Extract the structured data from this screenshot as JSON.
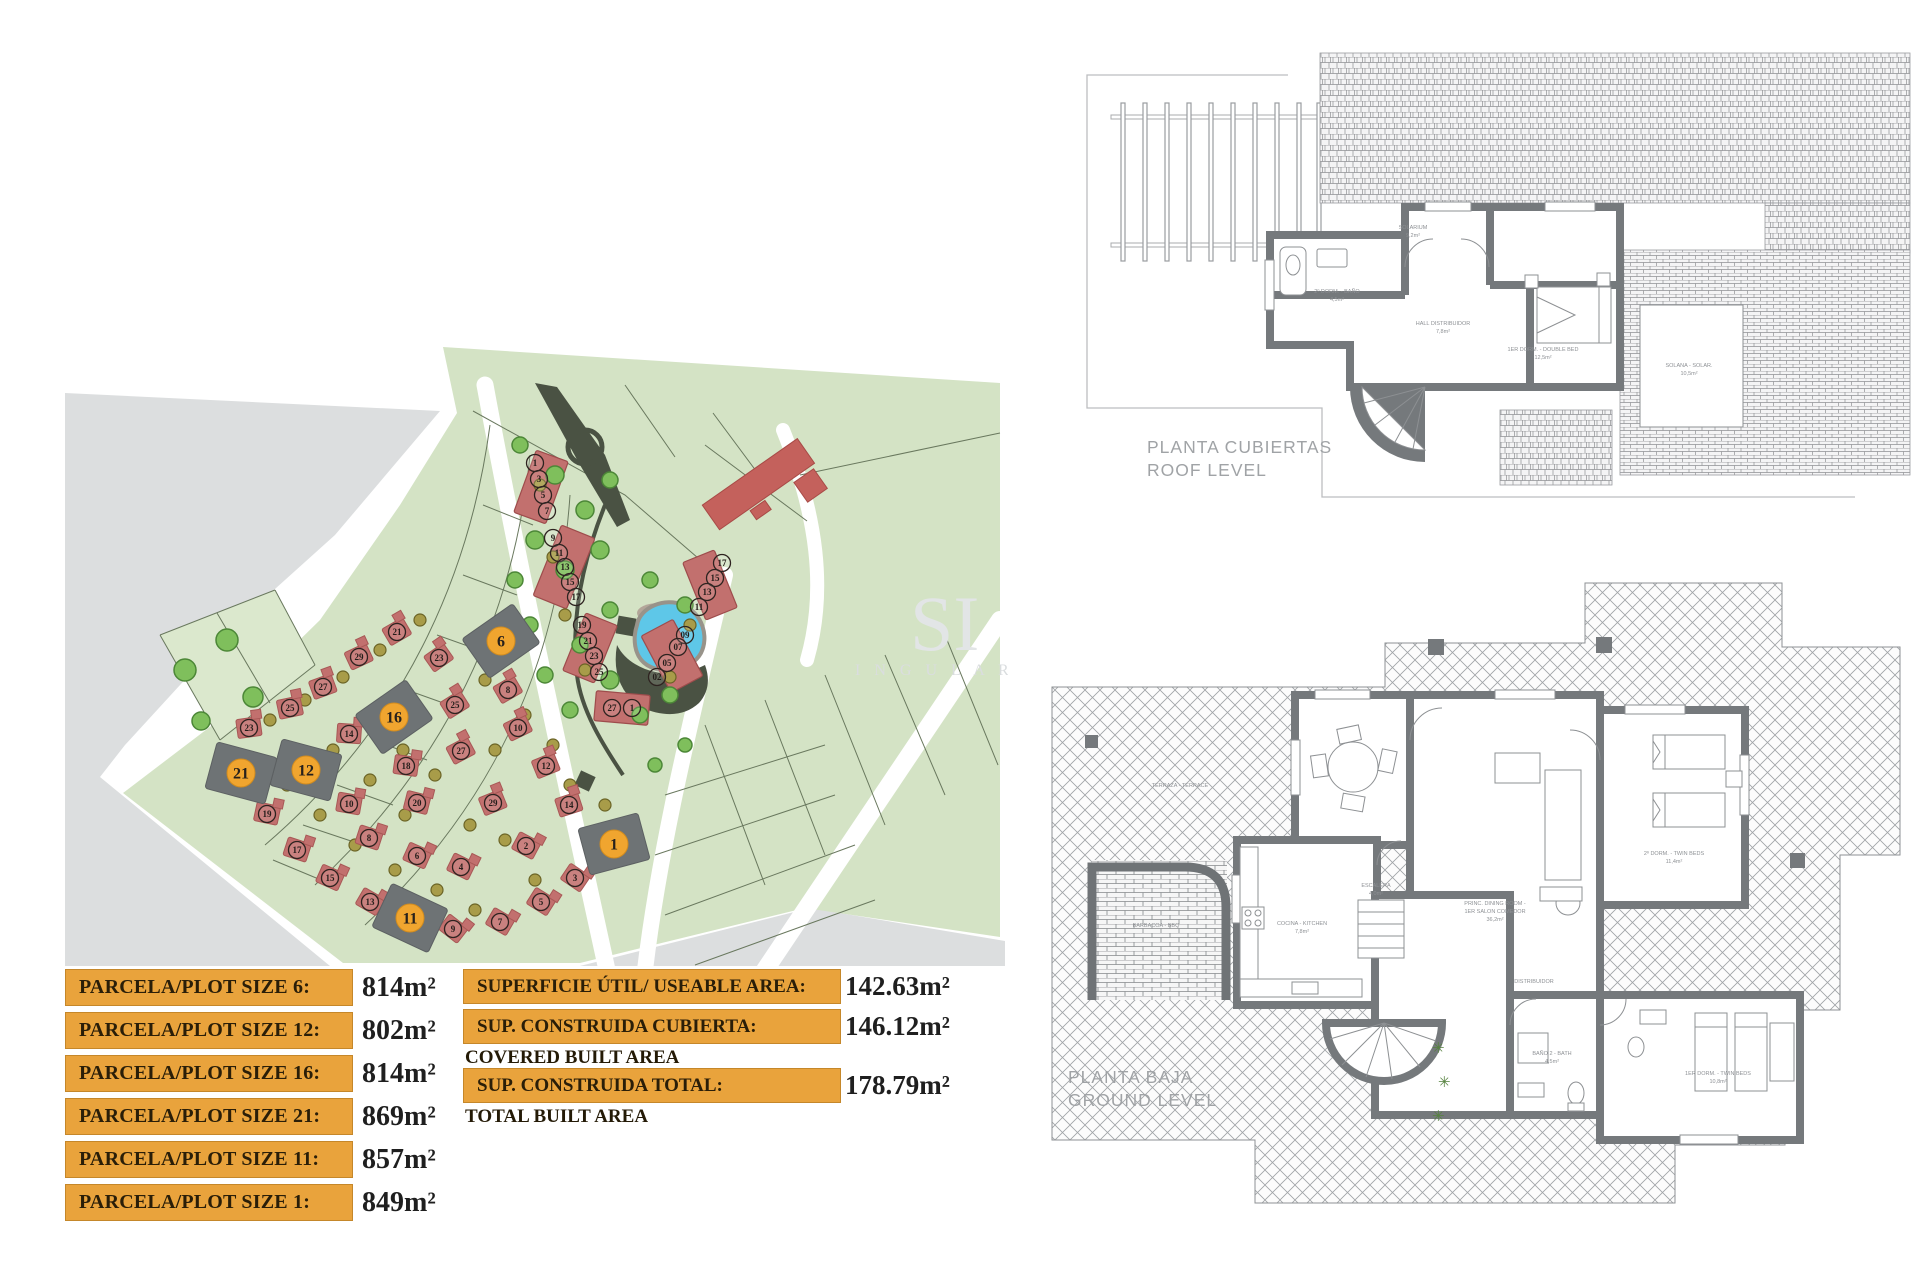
{
  "page": {
    "accent_orange": "#e9a33c",
    "plot_orange": "#f0a52f",
    "house_red": "#c2706e",
    "terrain_green": "#d4e3c5"
  },
  "site_plan": {
    "watermark": {
      "big": "SI",
      "small": "I N G U L A R"
    },
    "plots": [
      {
        "n": "6",
        "x": 436,
        "y": 316,
        "a": -35
      },
      {
        "n": "16",
        "x": 329,
        "y": 392,
        "a": -35
      },
      {
        "n": "12",
        "x": 241,
        "y": 445,
        "a": 15
      },
      {
        "n": "21",
        "x": 176,
        "y": 448,
        "a": 15
      },
      {
        "n": "11",
        "x": 345,
        "y": 593,
        "a": 25
      },
      {
        "n": "1",
        "x": 549,
        "y": 519,
        "a": -15
      }
    ],
    "terrace_bars": [
      {
        "x": 476,
        "y": 162,
        "w": 34,
        "h": 66,
        "a": 20
      },
      {
        "x": 499,
        "y": 242,
        "w": 36,
        "h": 76,
        "a": 22
      },
      {
        "x": 525,
        "y": 323,
        "w": 34,
        "h": 62,
        "a": 22
      },
      {
        "x": 557,
        "y": 383,
        "w": 54,
        "h": 30,
        "a": 5
      },
      {
        "x": 645,
        "y": 260,
        "w": 34,
        "h": 62,
        "a": -22
      },
      {
        "x": 607,
        "y": 331,
        "w": 36,
        "h": 64,
        "a": -28
      }
    ],
    "bar_units": [
      {
        "n": "1",
        "x": 470,
        "y": 138
      },
      {
        "n": "3",
        "x": 474,
        "y": 154
      },
      {
        "n": "5",
        "x": 478,
        "y": 170
      },
      {
        "n": "7",
        "x": 482,
        "y": 186
      },
      {
        "n": "9",
        "x": 488,
        "y": 213
      },
      {
        "n": "11",
        "x": 494,
        "y": 228
      },
      {
        "n": "13",
        "x": 500,
        "y": 242
      },
      {
        "n": "15",
        "x": 505,
        "y": 257
      },
      {
        "n": "17",
        "x": 511,
        "y": 272
      },
      {
        "n": "19",
        "x": 517,
        "y": 300
      },
      {
        "n": "21",
        "x": 523,
        "y": 316
      },
      {
        "n": "23",
        "x": 529,
        "y": 331
      },
      {
        "n": "25",
        "x": 534,
        "y": 347
      },
      {
        "n": "27",
        "x": 547,
        "y": 383
      },
      {
        "n": "1",
        "x": 567,
        "y": 383
      },
      {
        "n": "17",
        "x": 657,
        "y": 238
      },
      {
        "n": "15",
        "x": 650,
        "y": 253
      },
      {
        "n": "13",
        "x": 642,
        "y": 267
      },
      {
        "n": "11",
        "x": 634,
        "y": 282
      },
      {
        "n": "09",
        "x": 620,
        "y": 310
      },
      {
        "n": "07",
        "x": 613,
        "y": 322
      },
      {
        "n": "05",
        "x": 602,
        "y": 338
      },
      {
        "n": "02",
        "x": 592,
        "y": 352
      }
    ],
    "houses": [
      {
        "n": "21",
        "x": 332,
        "y": 307,
        "a": -30
      },
      {
        "n": "29",
        "x": 294,
        "y": 332,
        "a": -25
      },
      {
        "n": "27",
        "x": 258,
        "y": 362,
        "a": -20
      },
      {
        "n": "25",
        "x": 225,
        "y": 383,
        "a": -12
      },
      {
        "n": "23",
        "x": 184,
        "y": 403,
        "a": -8
      },
      {
        "n": "23",
        "x": 374,
        "y": 333,
        "a": -35
      },
      {
        "n": "25",
        "x": 390,
        "y": 380,
        "a": -32
      },
      {
        "n": "27",
        "x": 396,
        "y": 426,
        "a": -28
      },
      {
        "n": "29",
        "x": 428,
        "y": 478,
        "a": -22
      },
      {
        "n": "8",
        "x": 443,
        "y": 365,
        "a": -30
      },
      {
        "n": "10",
        "x": 453,
        "y": 403,
        "a": -26
      },
      {
        "n": "12",
        "x": 481,
        "y": 441,
        "a": -22
      },
      {
        "n": "14",
        "x": 504,
        "y": 480,
        "a": -18
      },
      {
        "n": "14",
        "x": 284,
        "y": 409,
        "a": 4
      },
      {
        "n": "18",
        "x": 341,
        "y": 441,
        "a": 8
      },
      {
        "n": "20",
        "x": 352,
        "y": 478,
        "a": 14
      },
      {
        "n": "10",
        "x": 284,
        "y": 479,
        "a": 10
      },
      {
        "n": "8",
        "x": 304,
        "y": 513,
        "a": 18
      },
      {
        "n": "6",
        "x": 352,
        "y": 531,
        "a": 24
      },
      {
        "n": "2",
        "x": 461,
        "y": 521,
        "a": 28
      },
      {
        "n": "4",
        "x": 396,
        "y": 542,
        "a": 26
      },
      {
        "n": "19",
        "x": 202,
        "y": 489,
        "a": 12
      },
      {
        "n": "17",
        "x": 232,
        "y": 525,
        "a": 18
      },
      {
        "n": "15",
        "x": 265,
        "y": 553,
        "a": 24
      },
      {
        "n": "13",
        "x": 305,
        "y": 577,
        "a": 30
      },
      {
        "n": "9",
        "x": 388,
        "y": 604,
        "a": 38
      },
      {
        "n": "3",
        "x": 510,
        "y": 553,
        "a": 34
      },
      {
        "n": "5",
        "x": 476,
        "y": 577,
        "a": 32
      },
      {
        "n": "7",
        "x": 435,
        "y": 597,
        "a": 30
      }
    ],
    "trees": [
      {
        "x": 120,
        "y": 345,
        "r": 11,
        "c": "g"
      },
      {
        "x": 162,
        "y": 315,
        "r": 11,
        "c": "g"
      },
      {
        "x": 188,
        "y": 372,
        "r": 10,
        "c": "g"
      },
      {
        "x": 136,
        "y": 396,
        "r": 9,
        "c": "g"
      },
      {
        "x": 455,
        "y": 120,
        "r": 8,
        "c": "g"
      },
      {
        "x": 490,
        "y": 150,
        "r": 9,
        "c": "g"
      },
      {
        "x": 520,
        "y": 185,
        "r": 9,
        "c": "g"
      },
      {
        "x": 545,
        "y": 155,
        "r": 8,
        "c": "g"
      },
      {
        "x": 470,
        "y": 215,
        "r": 9,
        "c": "g"
      },
      {
        "x": 500,
        "y": 245,
        "r": 9,
        "c": "g"
      },
      {
        "x": 535,
        "y": 225,
        "r": 9,
        "c": "g"
      },
      {
        "x": 585,
        "y": 255,
        "r": 8,
        "c": "g"
      },
      {
        "x": 620,
        "y": 280,
        "r": 8,
        "c": "g"
      },
      {
        "x": 545,
        "y": 285,
        "r": 8,
        "c": "g"
      },
      {
        "x": 515,
        "y": 320,
        "r": 8,
        "c": "g"
      },
      {
        "x": 545,
        "y": 355,
        "r": 9,
        "c": "g"
      },
      {
        "x": 575,
        "y": 390,
        "r": 8,
        "c": "g"
      },
      {
        "x": 605,
        "y": 370,
        "r": 8,
        "c": "g"
      },
      {
        "x": 505,
        "y": 385,
        "r": 8,
        "c": "g"
      },
      {
        "x": 480,
        "y": 350,
        "r": 8,
        "c": "g"
      },
      {
        "x": 465,
        "y": 300,
        "r": 8,
        "c": "g"
      },
      {
        "x": 450,
        "y": 255,
        "r": 8,
        "c": "g"
      },
      {
        "x": 620,
        "y": 420,
        "r": 7,
        "c": "g"
      },
      {
        "x": 590,
        "y": 440,
        "r": 7,
        "c": "g"
      },
      {
        "x": 475,
        "y": 160,
        "r": 6,
        "c": "o"
      },
      {
        "x": 488,
        "y": 232,
        "r": 6,
        "c": "o"
      },
      {
        "x": 500,
        "y": 290,
        "r": 6,
        "c": "o"
      },
      {
        "x": 520,
        "y": 345,
        "r": 6,
        "c": "o"
      },
      {
        "x": 625,
        "y": 300,
        "r": 6,
        "c": "o"
      },
      {
        "x": 605,
        "y": 352,
        "r": 6,
        "c": "o"
      },
      {
        "x": 355,
        "y": 295,
        "r": 6,
        "c": "o"
      },
      {
        "x": 315,
        "y": 325,
        "r": 6,
        "c": "o"
      },
      {
        "x": 278,
        "y": 352,
        "r": 6,
        "c": "o"
      },
      {
        "x": 240,
        "y": 375,
        "r": 6,
        "c": "o"
      },
      {
        "x": 205,
        "y": 395,
        "r": 6,
        "c": "o"
      },
      {
        "x": 222,
        "y": 460,
        "r": 6,
        "c": "o"
      },
      {
        "x": 255,
        "y": 490,
        "r": 6,
        "c": "o"
      },
      {
        "x": 290,
        "y": 520,
        "r": 6,
        "c": "o"
      },
      {
        "x": 330,
        "y": 545,
        "r": 6,
        "c": "o"
      },
      {
        "x": 372,
        "y": 565,
        "r": 6,
        "c": "o"
      },
      {
        "x": 410,
        "y": 585,
        "r": 6,
        "c": "o"
      },
      {
        "x": 300,
        "y": 395,
        "r": 6,
        "c": "o"
      },
      {
        "x": 268,
        "y": 425,
        "r": 6,
        "c": "o"
      },
      {
        "x": 338,
        "y": 425,
        "r": 6,
        "c": "o"
      },
      {
        "x": 305,
        "y": 455,
        "r": 6,
        "c": "o"
      },
      {
        "x": 370,
        "y": 450,
        "r": 6,
        "c": "o"
      },
      {
        "x": 340,
        "y": 490,
        "r": 6,
        "c": "o"
      },
      {
        "x": 405,
        "y": 500,
        "r": 6,
        "c": "o"
      },
      {
        "x": 440,
        "y": 515,
        "r": 6,
        "c": "o"
      },
      {
        "x": 470,
        "y": 555,
        "r": 6,
        "c": "o"
      },
      {
        "x": 430,
        "y": 425,
        "r": 6,
        "c": "o"
      },
      {
        "x": 460,
        "y": 390,
        "r": 6,
        "c": "o"
      },
      {
        "x": 420,
        "y": 355,
        "r": 6,
        "c": "o"
      },
      {
        "x": 488,
        "y": 420,
        "r": 6,
        "c": "o"
      },
      {
        "x": 505,
        "y": 460,
        "r": 6,
        "c": "o"
      },
      {
        "x": 540,
        "y": 480,
        "r": 6,
        "c": "o"
      }
    ]
  },
  "tables": {
    "plot_sizes": {
      "rows": [
        {
          "label": "PARCELA/PLOT SIZE 6:",
          "value": "814m²"
        },
        {
          "label": "PARCELA/PLOT SIZE 12:",
          "value": "802m²"
        },
        {
          "label": "PARCELA/PLOT SIZE 16:",
          "value": "814m²"
        },
        {
          "label": "PARCELA/PLOT SIZE 21:",
          "value": "869m²"
        },
        {
          "label": "PARCELA/PLOT SIZE 11:",
          "value": "857m²"
        },
        {
          "label": "PARCELA/PLOT SIZE 1:",
          "value": "849m²"
        }
      ]
    },
    "areas": {
      "rows": [
        {
          "label": "SUPERFICIE ÚTIL/ USEABLE AREA:",
          "sublabel": "",
          "value": "142.63m²"
        },
        {
          "label": "SUP. CONSTRUIDA CUBIERTA:",
          "sublabel": "COVERED BUILT AREA",
          "value": "146.12m²"
        },
        {
          "label": "SUP. CONSTRUIDA TOTAL:",
          "sublabel": "TOTAL BUILT AREA",
          "value": "178.79m²"
        }
      ]
    }
  },
  "floor_plans": {
    "roof": {
      "title_line1": "PLANTA CUBIERTAS",
      "title_line2": "ROOF LEVEL",
      "labels": [
        {
          "t": "2º DORM. - BAÑO",
          "x": 262,
          "y": 258
        },
        {
          "t": "4,5m²",
          "x": 262,
          "y": 266
        },
        {
          "t": "SOLARIUM",
          "x": 338,
          "y": 194
        },
        {
          "t": "9,2m²",
          "x": 338,
          "y": 202
        },
        {
          "t": "HALL DISTRIBUIDOR",
          "x": 368,
          "y": 290
        },
        {
          "t": "7,8m²",
          "x": 368,
          "y": 298
        },
        {
          "t": "1ER DORM. - DOUBLE BED",
          "x": 468,
          "y": 316
        },
        {
          "t": "12,5m²",
          "x": 468,
          "y": 324
        },
        {
          "t": "SOLANA - SOLAR.",
          "x": 614,
          "y": 332
        },
        {
          "t": "10,5m²",
          "x": 614,
          "y": 340
        }
      ]
    },
    "ground": {
      "title_line1": "PLANTA BAJA",
      "title_line2": "GROUND LEVEL",
      "labels": [
        {
          "t": "TERRAZA - TERRACE",
          "x": 140,
          "y": 232
        },
        {
          "t": "PRINC. DINING ROOM -",
          "x": 455,
          "y": 350
        },
        {
          "t": "1ER SALON COMEDOR",
          "x": 455,
          "y": 358
        },
        {
          "t": "36,2m²",
          "x": 455,
          "y": 366
        },
        {
          "t": "COCINA - KITCHEN",
          "x": 262,
          "y": 370
        },
        {
          "t": "7,8m²",
          "x": 262,
          "y": 378
        },
        {
          "t": "BARBACOA - BBQ",
          "x": 116,
          "y": 372
        },
        {
          "t": "ESCALERA",
          "x": 336,
          "y": 332
        },
        {
          "t": "4,0m²",
          "x": 336,
          "y": 340
        },
        {
          "t": "DISTRIBUIDOR",
          "x": 494,
          "y": 428
        },
        {
          "t": "BAÑO 2 - BATH",
          "x": 512,
          "y": 500
        },
        {
          "t": "4,5m²",
          "x": 512,
          "y": 508
        },
        {
          "t": "2º DORM. - TWIN BEDS",
          "x": 634,
          "y": 300
        },
        {
          "t": "11,4m²",
          "x": 634,
          "y": 308
        },
        {
          "t": "1ER DORM. - TWIN BEDS",
          "x": 678,
          "y": 520
        },
        {
          "t": "10,8m²",
          "x": 678,
          "y": 528
        }
      ]
    }
  }
}
